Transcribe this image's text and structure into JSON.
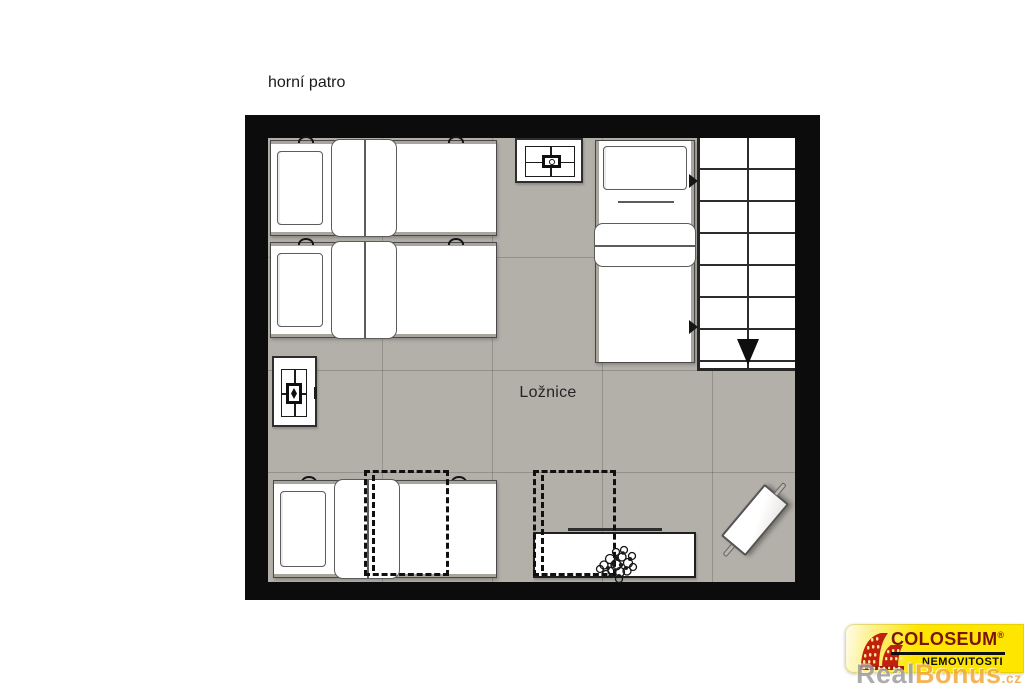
{
  "title": "horní patro",
  "room": {
    "label": "Ložnice"
  },
  "plan": {
    "wall_color": "#0C0C0C",
    "floor_color": "#B3AFA9",
    "furniture": [
      "twin-bed-top-1",
      "twin-bed-top-2",
      "bedside-table-with-lamp",
      "single-bed-right",
      "staircase-down",
      "wall-cabinet-with-lamp",
      "single-bed-bottom",
      "overhead-dashed-outline-1",
      "overhead-dashed-outline-2",
      "sideboard-with-plant",
      "diagonal-bench"
    ],
    "stairs": {
      "direction": "down",
      "treads": 7
    }
  },
  "logo": {
    "brand": "COLOSEUM",
    "registered": "®",
    "subtitle": "NEMOVITOSTI",
    "icon": "colosseum-icon",
    "colors": {
      "background": "#FFE600",
      "brand_text": "#7D1408",
      "subtitle_text": "#0D0D0D",
      "icon_red": "#C1200E"
    }
  },
  "watermark": {
    "part1": "Real",
    "part2": "Bonus",
    "suffix": ".cz",
    "color_part1": "#9E9E9E",
    "color_part2": "#F2A93B"
  }
}
